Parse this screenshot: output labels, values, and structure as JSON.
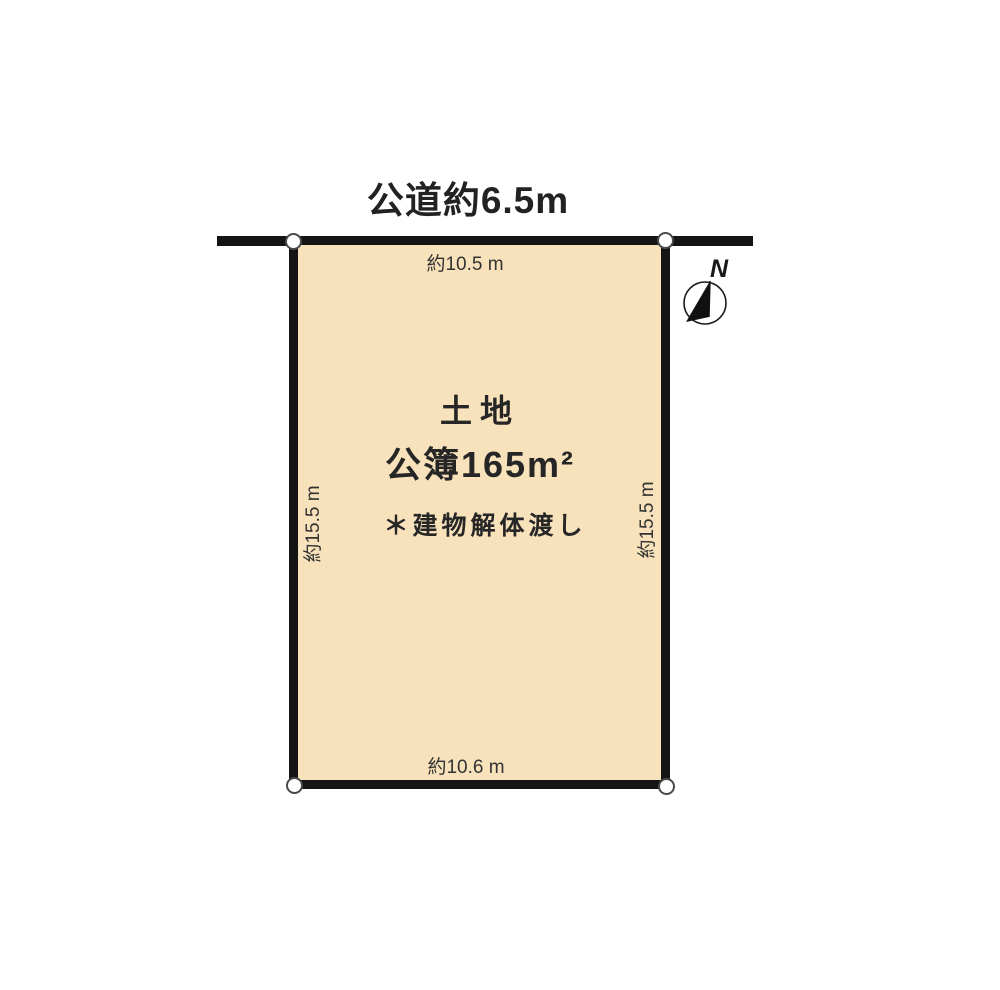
{
  "diagram": {
    "road_label": "公道約6.5m",
    "north_label": "N",
    "plot": {
      "title": "土地",
      "area": "公簿165m²",
      "note": "＊建物解体渡し",
      "top_dimension": "約10.5 m",
      "bottom_dimension": "約10.6 m",
      "left_dimension": "約15.5 m",
      "right_dimension": "約15.5 m"
    },
    "colors": {
      "plot_fill": "#f7e2bb",
      "line": "#141414",
      "text": "#262626",
      "background": "#ffffff"
    }
  }
}
